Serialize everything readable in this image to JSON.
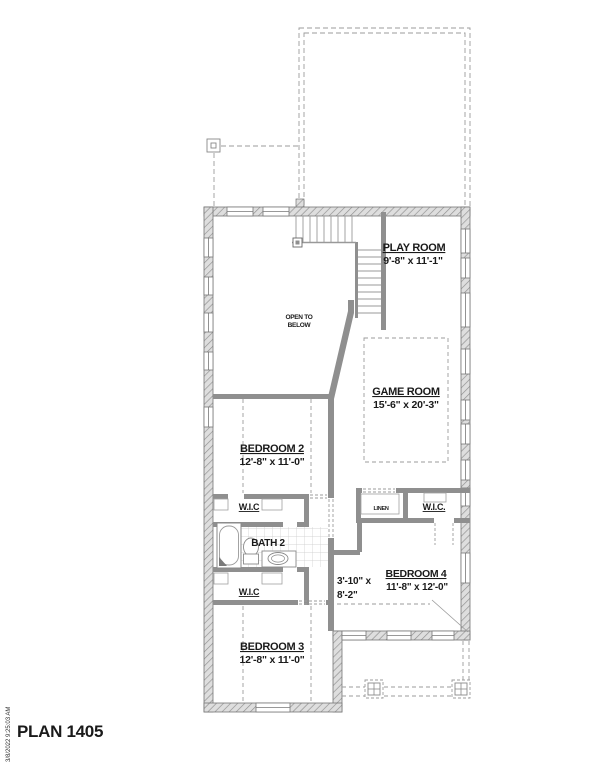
{
  "plan": {
    "title": "PLAN 1405",
    "timestamp": "3/8/2022 9:25:03 AM"
  },
  "rooms": {
    "play": {
      "name": "PLAY ROOM",
      "dims": "9'-8\" x 11'-1\""
    },
    "game": {
      "name": "GAME ROOM",
      "dims": "15'-6\" x 20'-3\""
    },
    "bed2": {
      "name": "BEDROOM 2",
      "dims": "12'-8\" x 11'-0\""
    },
    "bed3": {
      "name": "BEDROOM 3",
      "dims": "12'-8\" x 11'-0\""
    },
    "bed4": {
      "name": "BEDROOM 4",
      "dims": "11'-8\" x 12'-0\""
    },
    "bath2": {
      "name": "BATH 2"
    },
    "wic_top": {
      "name": "W.I.C"
    },
    "wic_bottom": {
      "name": "W.I.C"
    },
    "wic_right": {
      "name": "W.I.C."
    },
    "linen": {
      "name": "LINEN"
    },
    "open_below": {
      "line1": "OPEN TO",
      "line2": "BELOW"
    },
    "hall": {
      "dims_line1": "3'-10\" x",
      "dims_line2": "8'-2\""
    }
  },
  "colors": {
    "wall_fill": "#8f8f8f",
    "hatch_line": "#8f8f8f",
    "dash_line": "#9b9b9b",
    "text": "#1a1a1a"
  }
}
